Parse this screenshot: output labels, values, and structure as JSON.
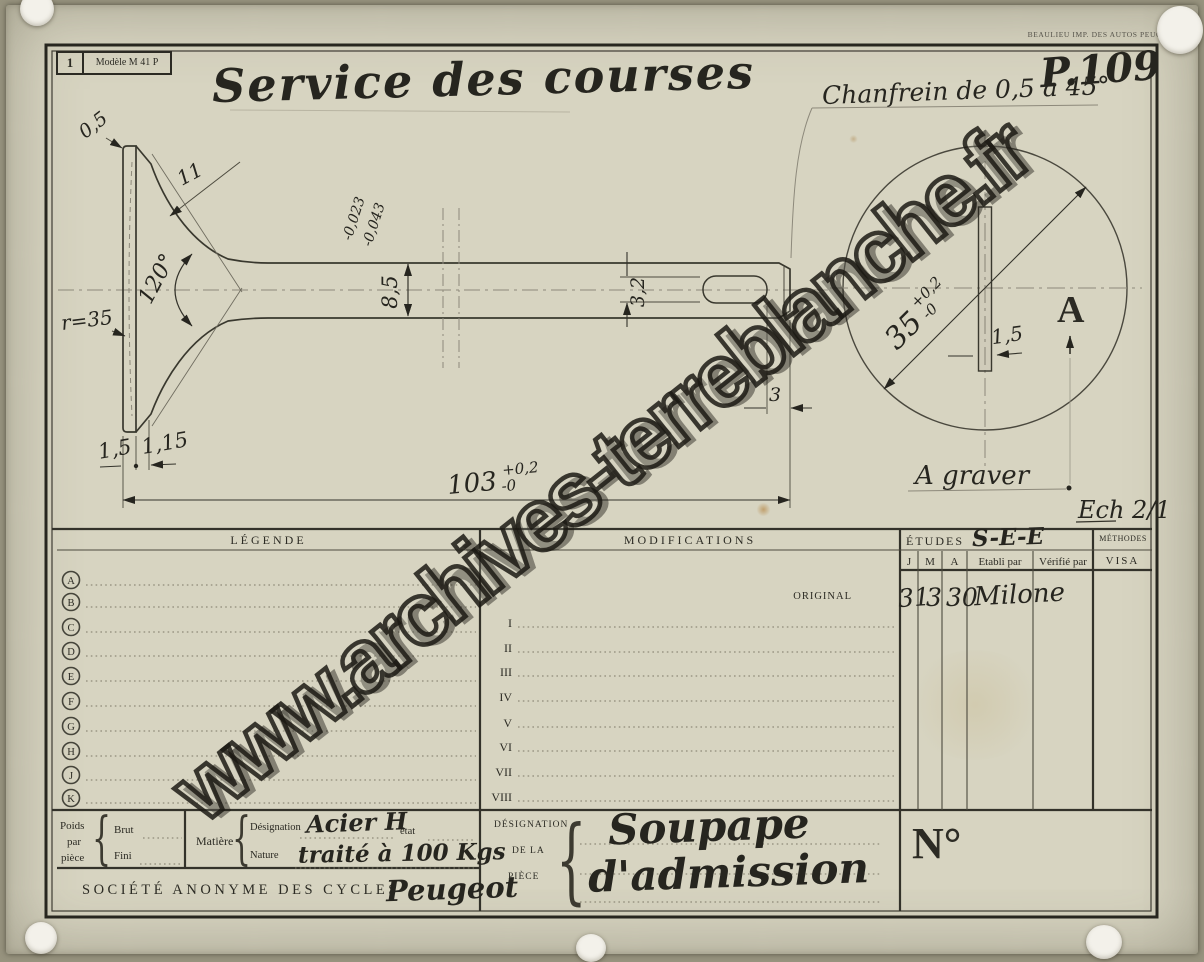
{
  "meta": {
    "stamp_number": "1",
    "model_label": "Modèle M 41 P",
    "title": "Service des courses",
    "plan_number": "P.109",
    "printer_note": "BEAULIEU IMP. DES AUTOS PEUGEOT",
    "watermark": "www.archives-terreblanche.fr"
  },
  "drawing": {
    "chamfer_note": "Chanfrein de 0,5 à 45°",
    "engrave_note": "A graver",
    "scale_note": "Ech 2/1",
    "view_label": "A",
    "dims": {
      "edge": "0,5",
      "seat_width": "11",
      "seat_angle": "120°",
      "face_radius": "r=35",
      "stem_dia": "8,5",
      "stem_tol_hi": "-0,023",
      "stem_tol_lo": "-0,043",
      "slot_height": "3,2",
      "slot_to_end": "3",
      "length": "103",
      "length_tol_hi": "+0,2",
      "length_tol_lo": "-0",
      "head_t1": "1,5",
      "head_t2": "1,15",
      "head_dia": "35",
      "head_dia_tol_hi": "+0,2",
      "head_dia_tol_lo": "-0",
      "slot_width": "1,5"
    }
  },
  "table": {
    "legende_header": "LÉGENDE",
    "legende_rows": [
      "A",
      "B",
      "C",
      "D",
      "E",
      "F",
      "G",
      "H",
      "J",
      "K"
    ],
    "modifications_header": "MODIFICATIONS",
    "modification_rows": [
      "I",
      "II",
      "III",
      "IV",
      "V",
      "VI",
      "VII",
      "VIII"
    ],
    "original_label": "ORIGINAL",
    "etudes_header": "ÉTUDES",
    "etudes_note": "S-E-E",
    "col_j": "J",
    "col_m": "M",
    "col_a": "A",
    "col_etabli": "Etabli par",
    "col_verifie": "Vérifié par",
    "methodes_header": "MÉTHODES",
    "visa_header": "VISA",
    "original_j": "31",
    "original_m": "3",
    "original_a": "30",
    "original_etabli": "Milone"
  },
  "footer": {
    "brace": "{",
    "poids_l1": "Poids",
    "poids_l2": "par",
    "poids_l3": "pièce",
    "brut": "Brut",
    "fini": "Fini",
    "matiere": "Matière",
    "designation_label": "Désignation",
    "designation_value": "Acier H",
    "etat_label": "état",
    "nature_label": "Nature",
    "nature_value": "traité à 100 Kgs",
    "company": "SOCIÉTÉ ANONYME DES CYCLES",
    "brand": "Peugeot",
    "piece_l1": "DÉSIGNATION",
    "piece_l2": "DE LA",
    "piece_l3": "PIÈCE",
    "piece_value1": "Soupape",
    "piece_value2": "d'admission",
    "numero": "N°"
  }
}
